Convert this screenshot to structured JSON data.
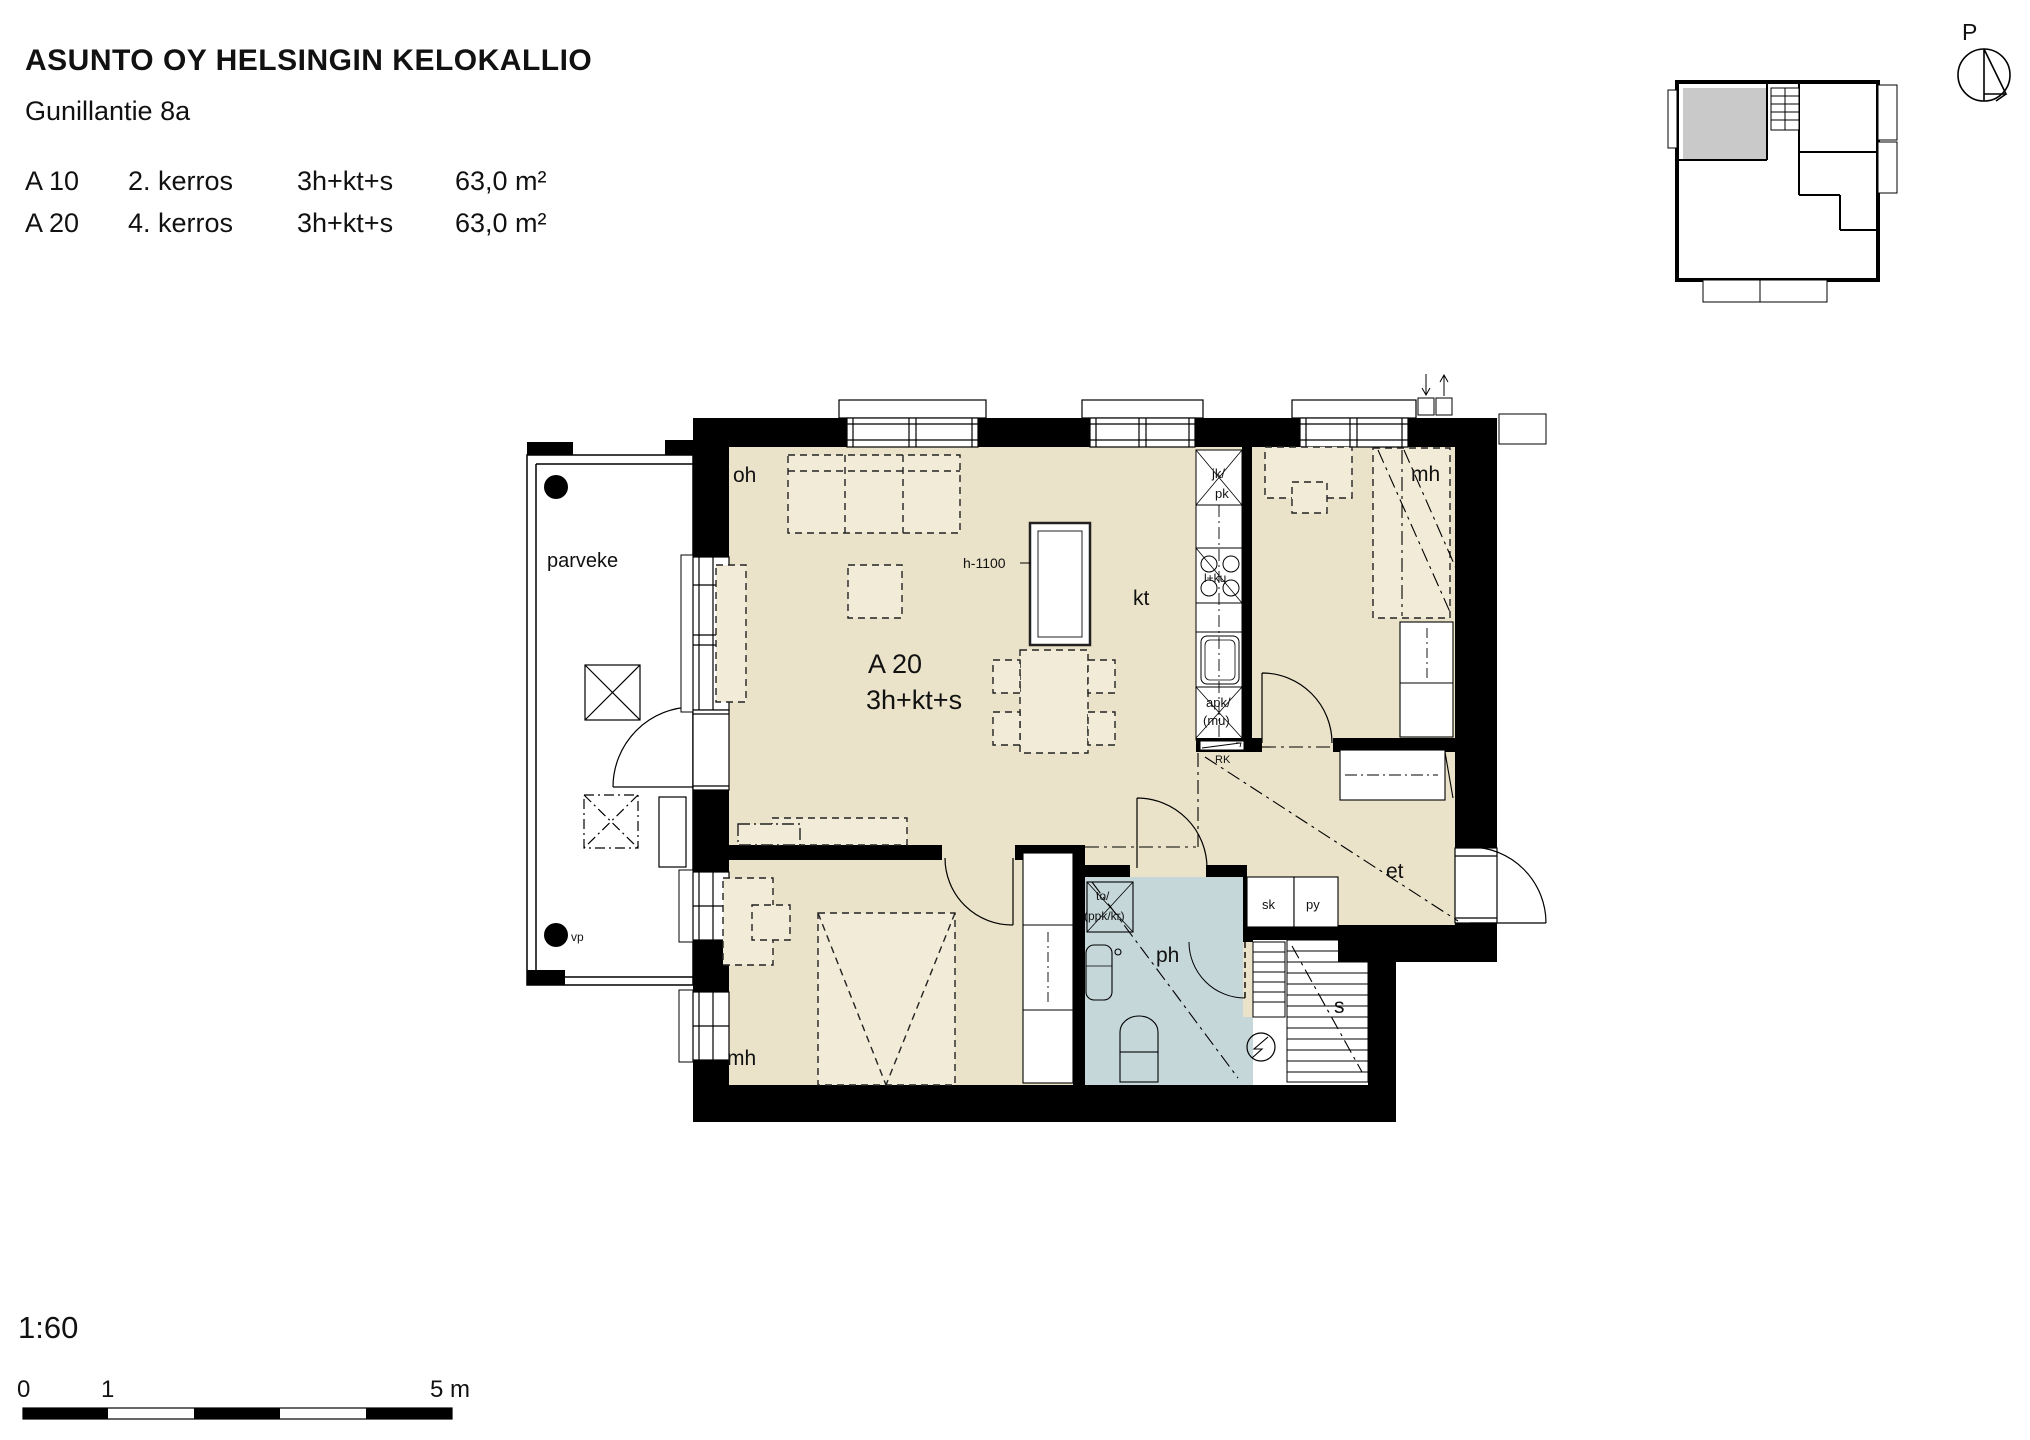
{
  "header": {
    "title": "ASUNTO OY HELSINGIN KELOKALLIO",
    "address": "Gunillantie 8a",
    "units": [
      {
        "id": "A 10",
        "floor": "2. kerros",
        "layout": "3h+kt+s",
        "area": "63,0 m²"
      },
      {
        "id": "A 20",
        "floor": "4. kerros",
        "layout": "3h+kt+s",
        "area": "63,0 m²"
      }
    ]
  },
  "plan": {
    "unit_label": "A 20",
    "unit_type": "3h+kt+s",
    "rooms": {
      "living": "oh",
      "kitchen": "kt",
      "bedroom_top": "mh",
      "bedroom_bottom": "mh",
      "hall": "et",
      "bathroom": "ph",
      "sauna": "s",
      "closet_sk": "sk",
      "closet_py": "py",
      "balcony": "parveke"
    },
    "fixtures": {
      "fridge_line1": "jk/",
      "fridge_line2": "pk",
      "stove": "l+ku",
      "dishwasher_line1": "apk/",
      "dishwasher_line2": "(mu)",
      "electric_board": "RK",
      "washer_line1": "to/",
      "washer_line2": "(ppk/kr)",
      "counter_height": "h-1100",
      "balcony_drain": "vp"
    }
  },
  "north_label": "P",
  "scale": {
    "ratio": "1:60",
    "tick_0": "0",
    "tick_1": "1",
    "tick_5": "5 m"
  },
  "colors": {
    "room_beige": "#eae3c9",
    "furniture_beige": "#f1ebd7",
    "wet_blue": "#c6d7da",
    "keyplan_gray": "#c9c9c9",
    "wall_black": "#000000"
  }
}
